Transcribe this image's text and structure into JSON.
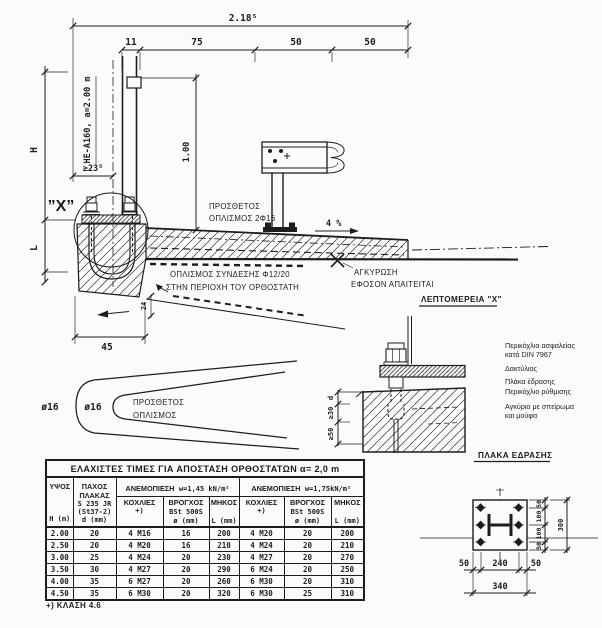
{
  "colors": {
    "ink": "#1c1c1c",
    "paper": "#fbfbf9"
  },
  "drawing": {
    "dim_total": "2.18⁵",
    "dim_11": "11",
    "dim_75": "75",
    "dim_50a": "50",
    "dim_50b": "50",
    "dim_H": "H",
    "dim_L": "L",
    "dim_min235": "≥23⁵",
    "dim_100": "1.00",
    "dim_24": "24",
    "dim_45": "45",
    "slope": "4 %",
    "post_label": "HE-A160, a=2.00 m",
    "x_ref": "”X”",
    "extra1": "ΠΡΟΣΘΕΤΟΣ",
    "extra2": "ΟΠΛΙΣΜΟΣ 2Φ16",
    "conn1": "ΟΠΛΙΣΜΟΣ ΣΥΝΔΕΣΗΣ Φ12/20",
    "conn2": "ΣΤΗΝ ΠΕΡΙΟΧΗ ΤΟΥ ΟΡΘΟΣΤΑΤΗ",
    "anchor1": "ΑΓΚΥΡΩΣΗ",
    "anchor2": "ΕΦΟΣΟΝ ΑΠΑΙΤΕΙΤΑΙ",
    "phi16_outer": "ø16",
    "phi16_inner": "ø16",
    "hairpin1": "ΠΡΟΣΘΕΤΟΣ",
    "hairpin2": "ΟΠΛΙΣΜΟΣ",
    "detail_title": "ΛΕΠΤΟΜΕΡΕΙΑ \"X\"",
    "det_d": "d",
    "det_30": "≥30",
    "det_50": "≥50",
    "note_nut1": "Περικόχλια ασφαλείας",
    "note_nut2": "κατά DIN 7967",
    "note_ring": "Δακτύλιος",
    "note_plate": "Πλάκα έδρασης",
    "note_adj": "Περικόχλιο ρύθμισης",
    "note_anchor1": "Αγκύριο με σπείρωμα",
    "note_anchor2": "και μούφα",
    "plate_title": "ΠΛΑΚΑ ΕΔΡΑΣΗΣ",
    "pv_50a": "50",
    "pv_100a": "100",
    "pv_100b": "100",
    "pv_50b": "50",
    "pv_300": "300",
    "ph_50a": "50",
    "ph_240": "240",
    "ph_50b": "50",
    "ph_340": "340"
  },
  "table": {
    "title": "ΕΛΑΧΙΣΤΕΣ ΤΙΜΕΣ ΓΙΑ ΑΠΟΣΤΑΣΗ ΟΡΘΟΣΤΑΤΩΝ α= 2,0 m",
    "header": {
      "hgt1": "ΥΨΟΣ",
      "hgt2": "H (m)",
      "thk1": "ΠΑΧΟΣ",
      "thk2": "ΠΛΑΚΑΣ",
      "thk3": "S 235 JR",
      "thk4": "(St37-2)",
      "thk5": "d (mm)",
      "wind1a": "ΑΝΕΜΟΠΙΕΣΗ",
      "wind1b": "w=1,45 kN/m²",
      "wind2a": "ΑΝΕΜΟΠΙΕΣΗ",
      "wind2b": "w=1,75kN/m²",
      "bolts1": "ΚΟΧΛΙΕΣ",
      "bolts2": "+)",
      "loop1": "ΒΡΟΓΧΟΣ",
      "loop2": "BSt 500S",
      "loop3": "ø (mm)",
      "len1": "ΜΗΚΟΣ",
      "len2": "L (mm)"
    },
    "rows": [
      [
        "2.00",
        "20",
        "4 M16",
        "16",
        "200",
        "4 M20",
        "20",
        "200"
      ],
      [
        "2.50",
        "20",
        "4 M20",
        "16",
        "210",
        "4 M24",
        "20",
        "210"
      ],
      [
        "3.00",
        "25",
        "4 M24",
        "20",
        "230",
        "4 M27",
        "20",
        "270"
      ],
      [
        "3.50",
        "30",
        "4 M27",
        "20",
        "290",
        "6 M24",
        "20",
        "250"
      ],
      [
        "4.00",
        "35",
        "6 M27",
        "20",
        "260",
        "6 M30",
        "20",
        "310"
      ],
      [
        "4.50",
        "35",
        "6 M30",
        "20",
        "320",
        "6 M30",
        "25",
        "310"
      ]
    ],
    "footnote": "+) ΚΛΑΣΗ 4.6"
  }
}
